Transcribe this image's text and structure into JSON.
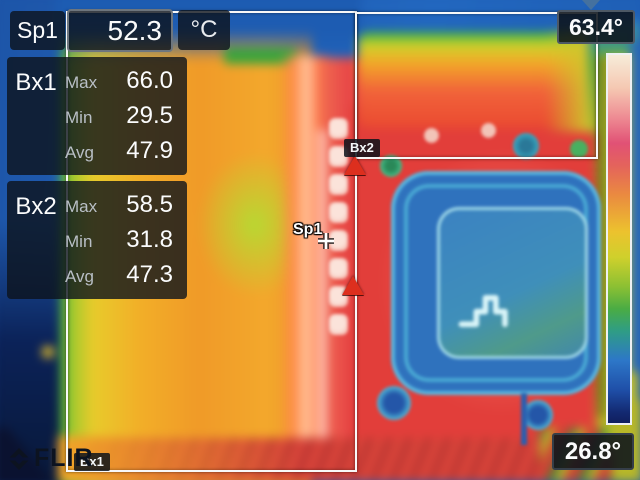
{
  "brand": "FLIR",
  "unit_label": "°C",
  "spot": {
    "id": "Sp1",
    "value": "52.3",
    "marker_label": "Sp1"
  },
  "boxes": [
    {
      "id": "Bx1",
      "tag": "Bx1",
      "rows": [
        {
          "label": "Max",
          "value": "66.0"
        },
        {
          "label": "Min",
          "value": "29.5"
        },
        {
          "label": "Avg",
          "value": "47.9"
        }
      ]
    },
    {
      "id": "Bx2",
      "tag": "Bx2",
      "rows": [
        {
          "label": "Max",
          "value": "58.5"
        },
        {
          "label": "Min",
          "value": "31.8"
        },
        {
          "label": "Avg",
          "value": "47.3"
        }
      ]
    }
  ],
  "scale": {
    "max": "63.4°",
    "min": "26.8°"
  },
  "colors": {
    "hotspot_marker": "#dd2f1e",
    "scale_indicator": "#44719f",
    "measurement_line": "#f8f8f8",
    "panel_background": "rgba(13,19,27,0.8)"
  }
}
